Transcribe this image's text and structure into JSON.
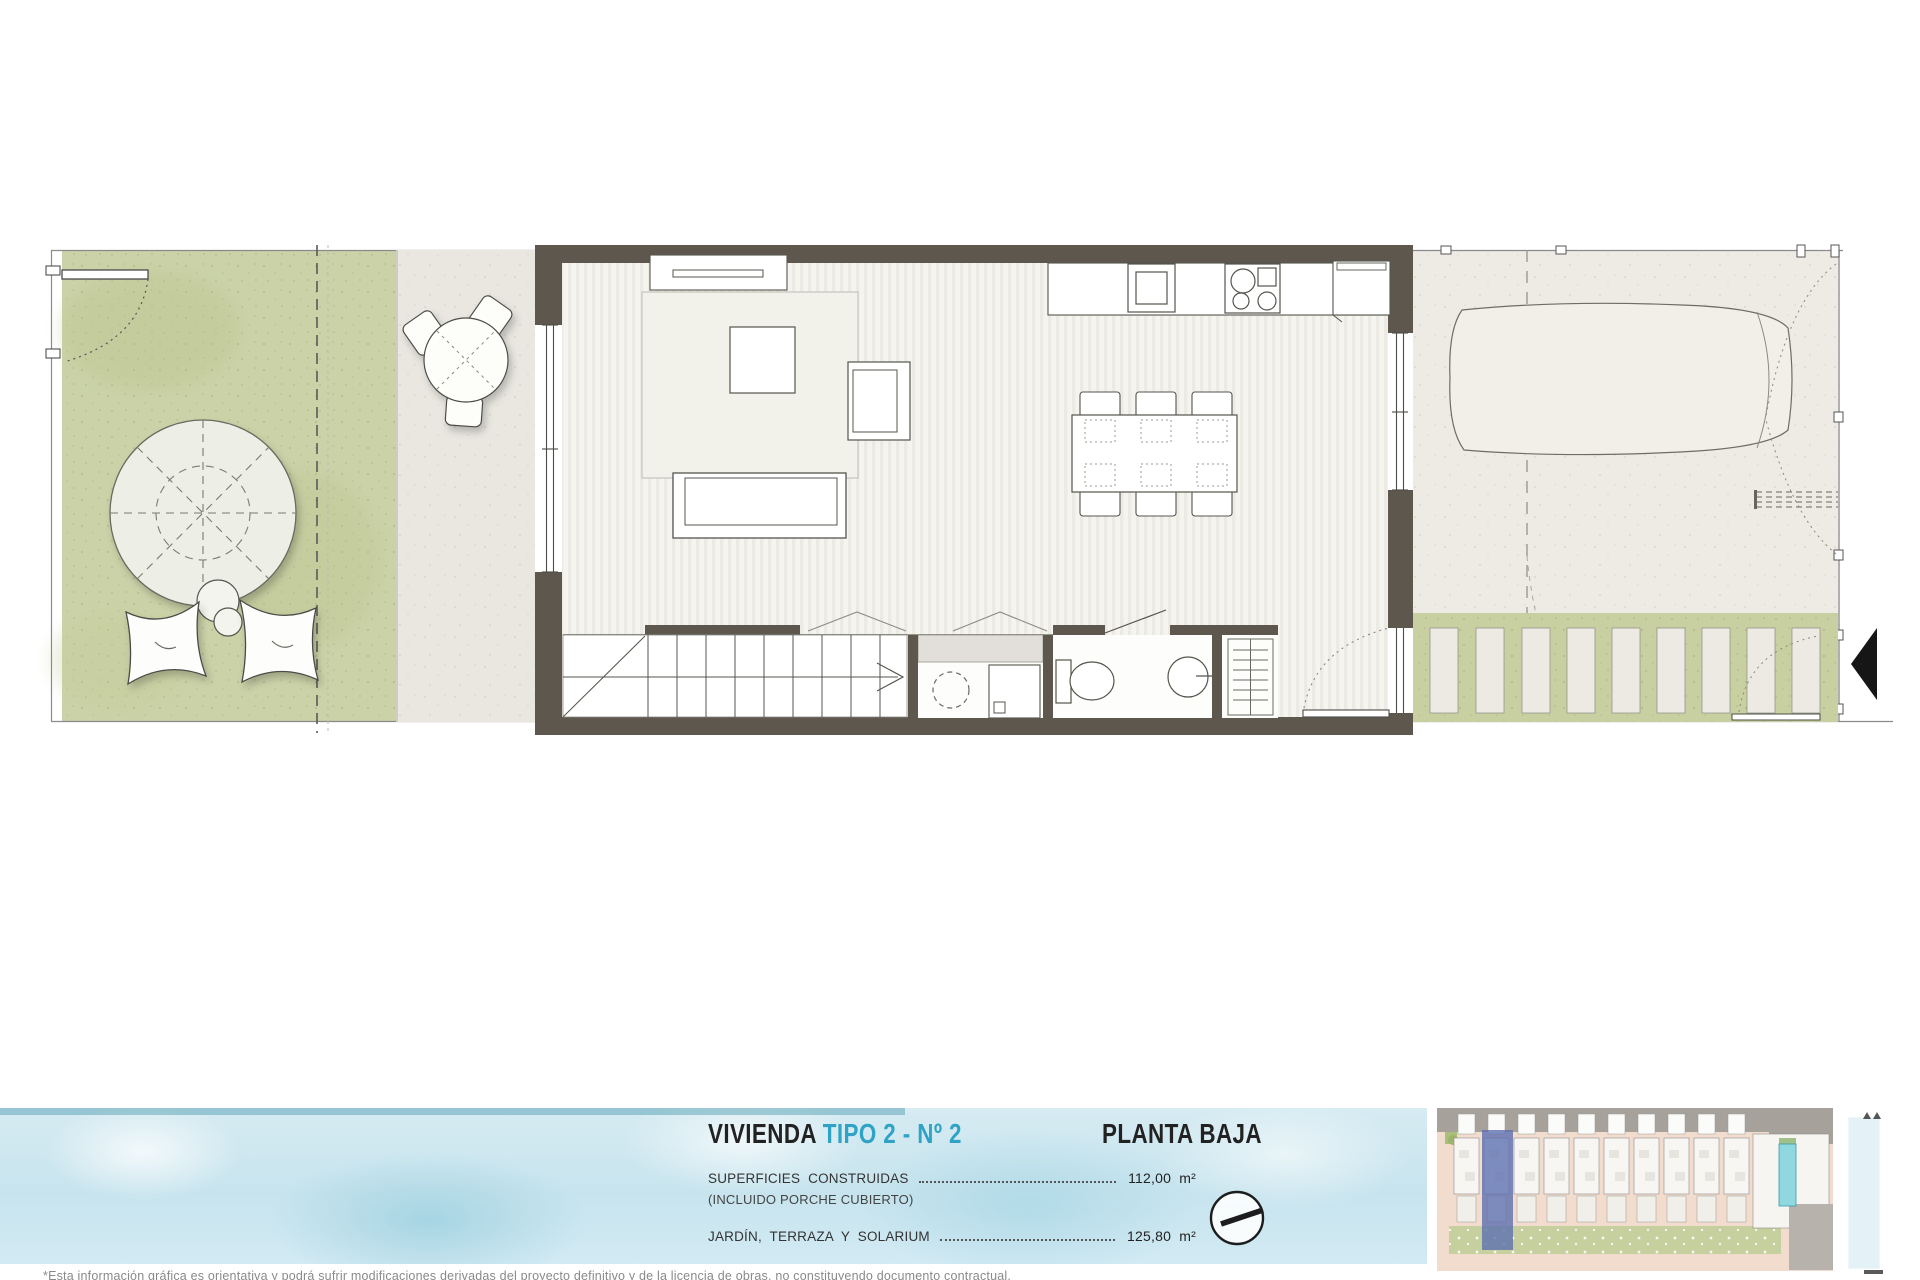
{
  "sheet": {
    "title": {
      "prefix": "VIVIENDA ",
      "accent": "TIPO 2 - Nº 2",
      "floor_label": "PLANTA BAJA"
    },
    "surfaces": {
      "built": {
        "label": "SUPERFICIES  CONSTRUIDAS",
        "sublabel": "(INCLUIDO PORCHE CUBIERTO)",
        "value": "112,00",
        "unit": "m²"
      },
      "garden": {
        "label": "JARDÍN,  TERRAZA  Y  SOLARIUM",
        "value": "125,80",
        "unit": "m²"
      }
    },
    "disclaimer": "*Esta información gráfica es orientativa y podrá sufrir modificaciones derivadas del proyecto definitivo y de la licencia de obras, no constituyendo documento contractual.",
    "site_plan": {
      "units_total": 11,
      "highlighted_unit": "Nº 2",
      "has_pool": true
    },
    "colors": {
      "accent_cyan": "#2fa3c6",
      "text_dark": "#222222",
      "wall": "#5e574e",
      "garden_green": "#cbd2a8",
      "pergola_green": "#c8cfa0",
      "terrace_beige": "#e9e7e0",
      "parking_beige": "#edebe4",
      "interior_floor": "#f4f3ee",
      "water_blue": "#cde7f0",
      "site_highlight_blue": "#5b6eb0",
      "site_pool_cyan": "#8fd8e0",
      "site_road_gray": "#a6a19b",
      "site_road_salmon": "#f2dccd",
      "site_garden_green": "#c6cf9e"
    }
  }
}
